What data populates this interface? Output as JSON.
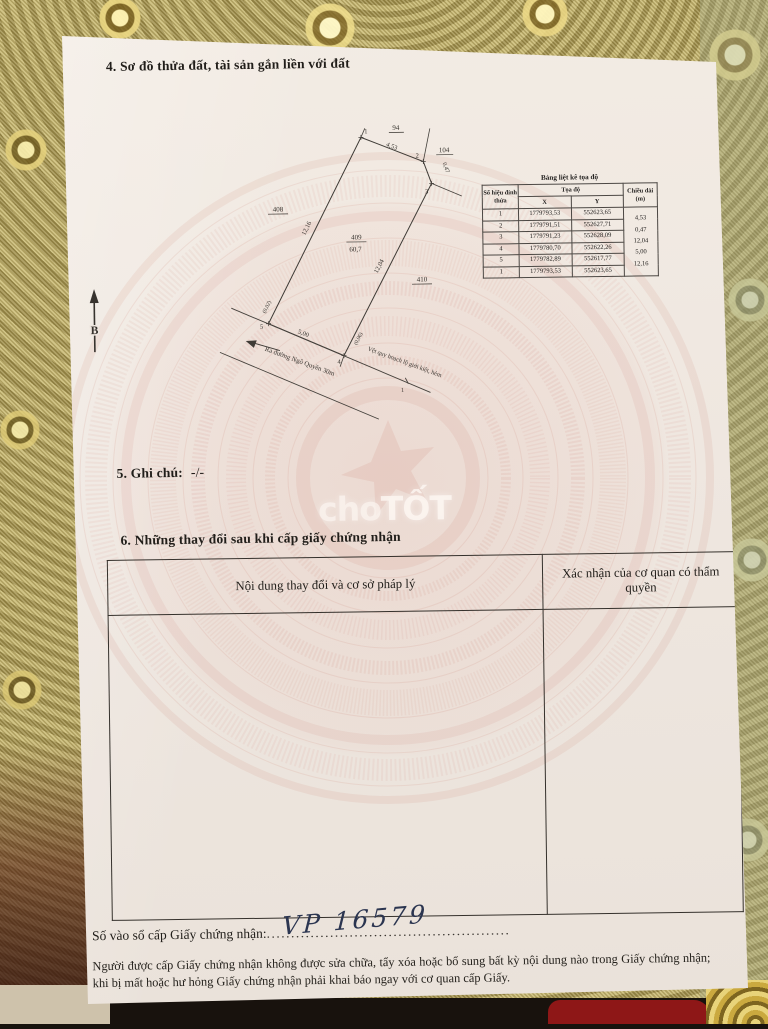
{
  "page": {
    "section4_title": "4. Sơ đồ thửa đất, tài sản gắn liền với đất",
    "section5_label": "5. Ghi chú:",
    "section5_value": "-/-",
    "section6_title": "6. Những thay đổi sau khi cấp giấy chứng nhận",
    "registry_label": "Số vào sổ cấp Giấy chứng nhận:",
    "registry_dots_left": "....................",
    "registry_dots_right": "..............................",
    "registry_value": "VP  16579",
    "footer_note": "Người được cấp Giấy chứng nhận không được sửa chữa, tẩy xóa hoặc bổ sung bất kỳ nội dung nào trong Giấy chứng nhận; khi bị mất hoặc hư hỏng Giấy chứng nhận phải khai báo ngay với cơ quan cấp Giấy."
  },
  "watermark": {
    "cho": "cho",
    "tot": "TỐT"
  },
  "diagram": {
    "north_label": "B",
    "parcels": {
      "p94": "94",
      "p104": "104",
      "p408": "408",
      "p409": "409",
      "p409_area": "60,7",
      "p410": "410"
    },
    "vertices": {
      "v1": "1",
      "v2": "2",
      "v3": "3",
      "v4": "4",
      "v5": "5"
    },
    "edges": {
      "e12": "4,53",
      "e23": "0,47",
      "e34": "12,04",
      "e45": "5,00",
      "e51": "12,16"
    },
    "offsets": {
      "v5": "(0,02)",
      "v4": "(0,06)"
    },
    "road_text": "Ra đường Ngô Quyền 30m",
    "planning_text": "Vệt quy hoạch lộ giới kiệt, hẻm",
    "planning_end_label": "1"
  },
  "coord_table": {
    "title": "Bảng liệt kê tọa độ",
    "col_vertex": "Số hiệu đỉnh thửa",
    "col_coords": "Tọa độ",
    "col_x": "X",
    "col_y": "Y",
    "col_length": "Chiều dài (m)",
    "rows": [
      [
        "1",
        "1779793,53",
        "552623,65"
      ],
      [
        "2",
        "1779791,51",
        "552627,71"
      ],
      [
        "3",
        "1779791,23",
        "552628,09"
      ],
      [
        "4",
        "1779780,70",
        "552622,26"
      ],
      [
        "5",
        "1779782,89",
        "552617,77"
      ],
      [
        "1",
        "1779793,53",
        "552623,65"
      ]
    ],
    "lengths": [
      "4,53",
      "0,47",
      "12,04",
      "5,00",
      "12,16"
    ]
  },
  "changes_table": {
    "col_content": "Nội dung thay đổi và cơ sở pháp lý",
    "col_confirm": "Xác nhận của cơ quan có thẩm quyền"
  },
  "colors": {
    "paper": "#efe7e0",
    "emblem_pink": "#c8695c",
    "lace_gold": "#b3a259",
    "ink_blue": "#2b3550"
  }
}
